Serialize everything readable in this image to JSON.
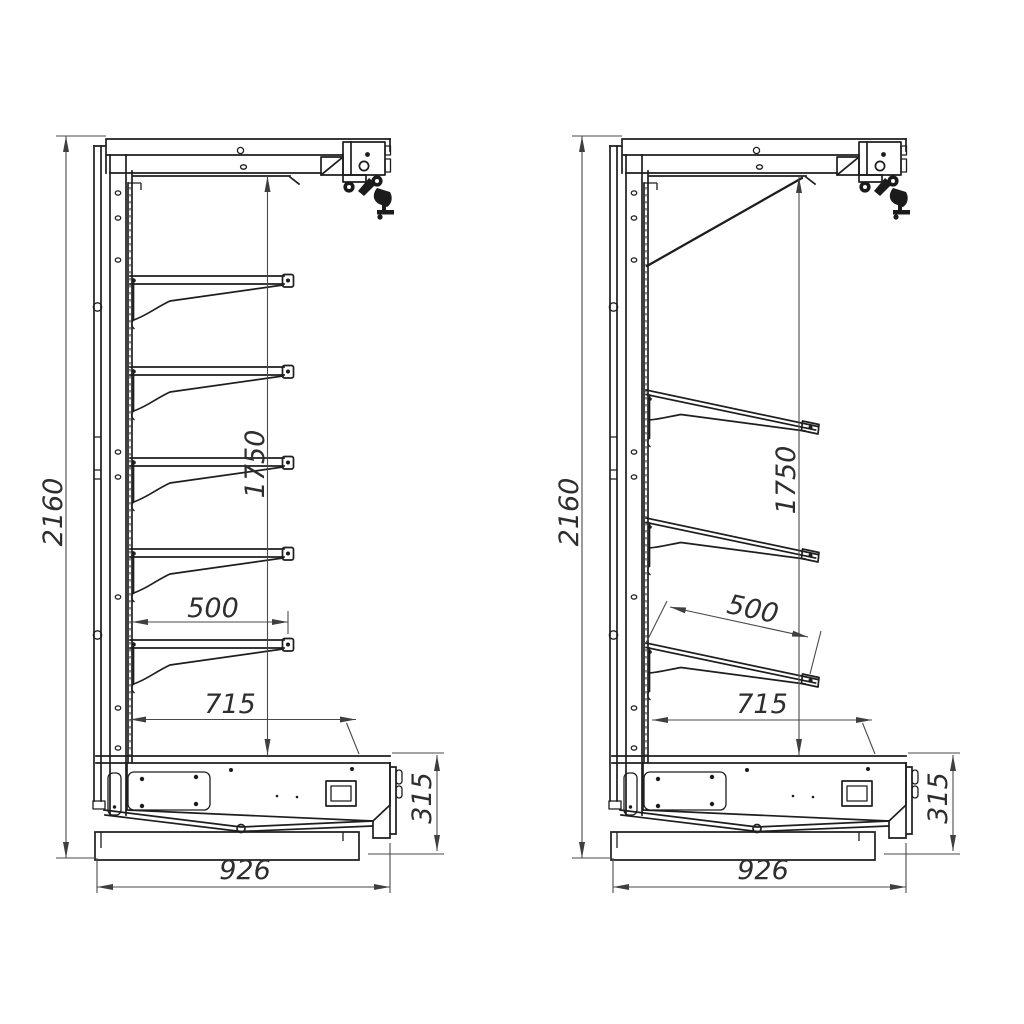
{
  "page": {
    "background": "#ffffff"
  },
  "drawing": {
    "colors": {
      "outline": "#1e1e1e",
      "dimension": "#4a4a4a",
      "label": "#2e2e2e"
    },
    "figures": [
      {
        "id": "left-view",
        "shelf_style": "horizontal",
        "shelf_count": 5,
        "dims": {
          "total_height": "2160",
          "inner_height": "1750",
          "shelf_depth": "500",
          "inner_depth": "715",
          "base_height": "315",
          "overall_depth": "926"
        }
      },
      {
        "id": "right-view",
        "shelf_style": "inclined",
        "shelf_count": 3,
        "dims": {
          "total_height": "2160",
          "inner_height": "1750",
          "shelf_depth": "500",
          "inner_depth": "715",
          "base_height": "315",
          "overall_depth": "926"
        }
      }
    ]
  }
}
